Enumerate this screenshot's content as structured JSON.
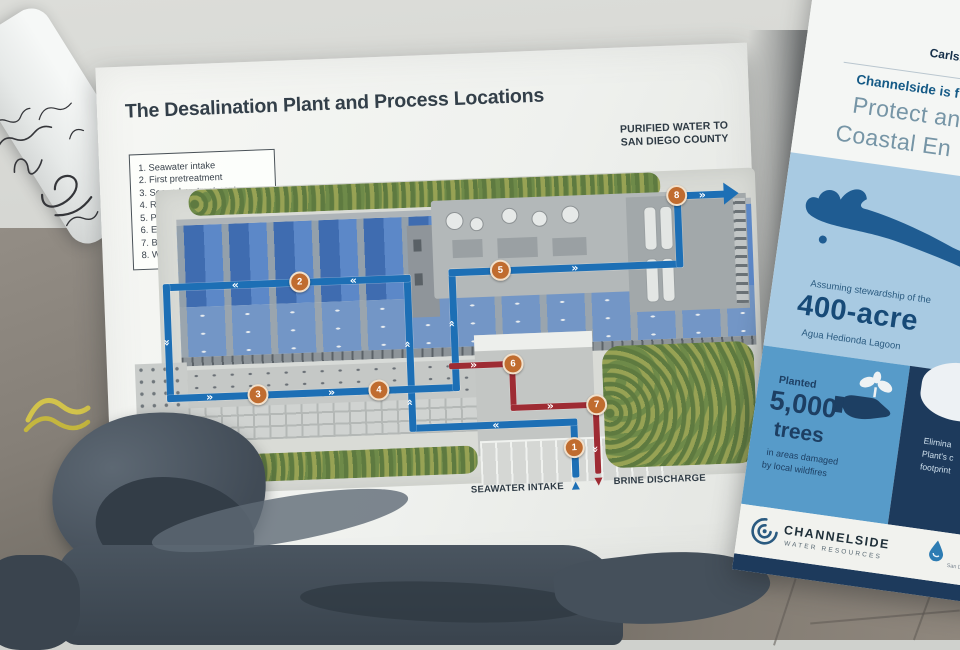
{
  "main_poster": {
    "title": "The Desalination Plant and Process Locations",
    "legend_items": [
      "1. Seawater intake",
      "2. First pretreatment",
      "3. Second pretreatment",
      "4. Reverse osmosis",
      "5. Post treatment",
      "6. Energy recovery",
      "7. Brine discharge",
      "8. Water distribution"
    ],
    "purified_label_line1": "PURIFIED WATER TO",
    "purified_label_line2": "SAN DIEGO COUNTY",
    "seawater_label": "SEAWATER INTAKE",
    "brine_label": "BRINE DISCHARGE",
    "markers": [
      "1",
      "2",
      "3",
      "4",
      "5",
      "6",
      "7",
      "8"
    ]
  },
  "side_poster": {
    "brand_line1": "Claude \"Bud\" Lewis",
    "brand_line2": "Carlsbad Desalination",
    "headline_small": "Channelside is f",
    "headline_line1": "Protect an",
    "headline_line2": "Coastal En",
    "lagoon_pre": "Assuming stewardship of the",
    "lagoon_acreage": "400-acre",
    "lagoon_name": "Agua Hedionda Lagoon",
    "trees_pre": "Planted",
    "trees_number": "5,000",
    "trees_word": "trees",
    "trees_line1": "in areas damaged",
    "trees_line2": "by local wildfires",
    "carbon_line1": "Elimina",
    "carbon_line2": "Plant's c",
    "carbon_line3": "footprint",
    "footer_brand": "CHANNELSIDE",
    "footer_sub": "WATER RESOURCES",
    "authority_small": "San Diego C"
  },
  "colors": {
    "pipe-blue": "#1d6fb5",
    "pipe-red": "#9e2b33",
    "marker-orange": "#c06c2f",
    "ink-navy": "#333f49",
    "side-navy": "#1d3a5c",
    "side-blue": "#579bc9",
    "side-lightblue": "#a8cae2"
  }
}
